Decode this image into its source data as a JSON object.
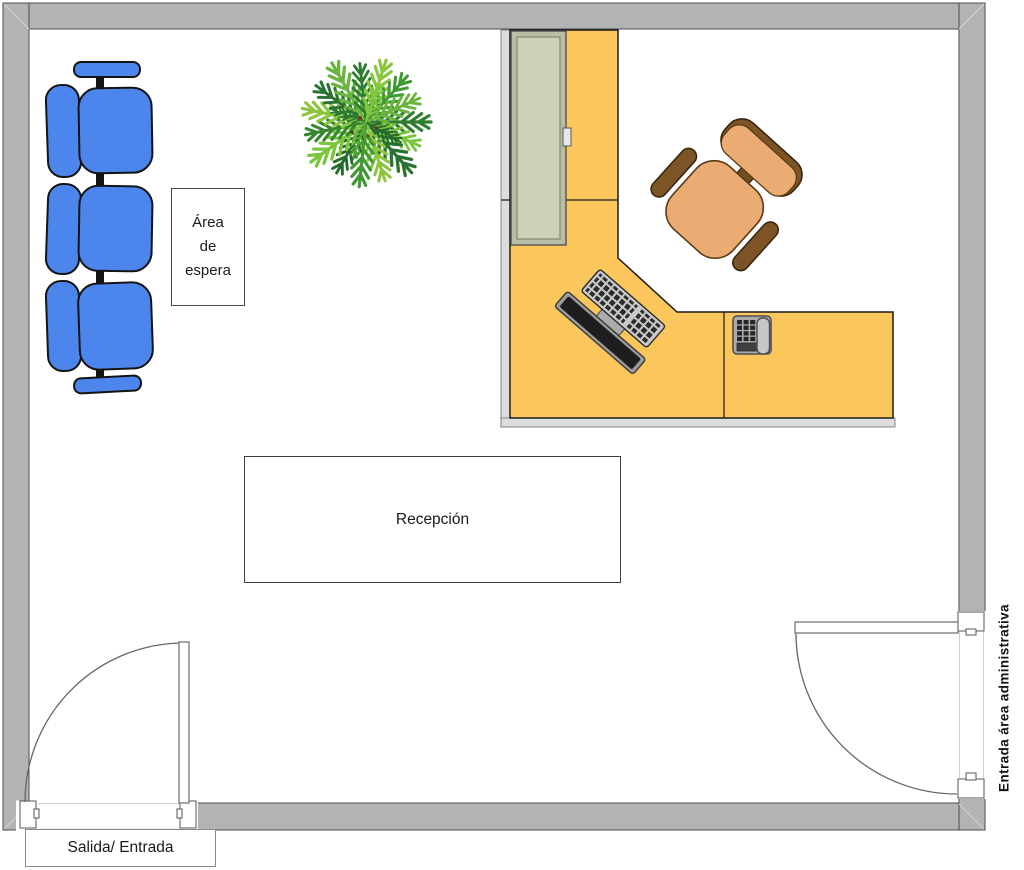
{
  "title_note": "reception office floor plan",
  "labels": {
    "waiting_area": {
      "lines": [
        "Área",
        "de",
        "espera"
      ]
    },
    "reception": "Recepción",
    "exit_entrance": "Salida/ Entrada",
    "admin_entrance": "Entrada área administrativa"
  },
  "objects": {
    "waiting_bench": "three-seat blue beam bench",
    "plant": "palm plant top view",
    "reception_desk": "L-shaped yellow desk",
    "cabinet": "tall cabinet on desk return",
    "office_chair": "tan office chair with brown armrests",
    "computer": "monitor and keyboard",
    "telephone": "desk phone",
    "entrance_door": "swing door bottom-left",
    "admin_door": "swing door right wall"
  },
  "colors": {
    "wall": "#B3B3B3",
    "wall_outline": "#4d4d4d",
    "floor": "#FFFFFF",
    "desk": "#FBC75C",
    "desk_outline": "#1c1c1c",
    "partition": "#DCDCDC",
    "cabinet_frame": "#B9BDA3",
    "cabinet_panel": "#CDD0B8",
    "bench_blue": "#4C86EC",
    "chair_seat_tan": "#EAAC72",
    "chair_armrest_brown": "#7D5426",
    "plant_green_dark": "#2A7330",
    "plant_green_light": "#8CC63F",
    "monitor_screen": "#1E1E1E",
    "device_gray": "#ABABAB"
  }
}
